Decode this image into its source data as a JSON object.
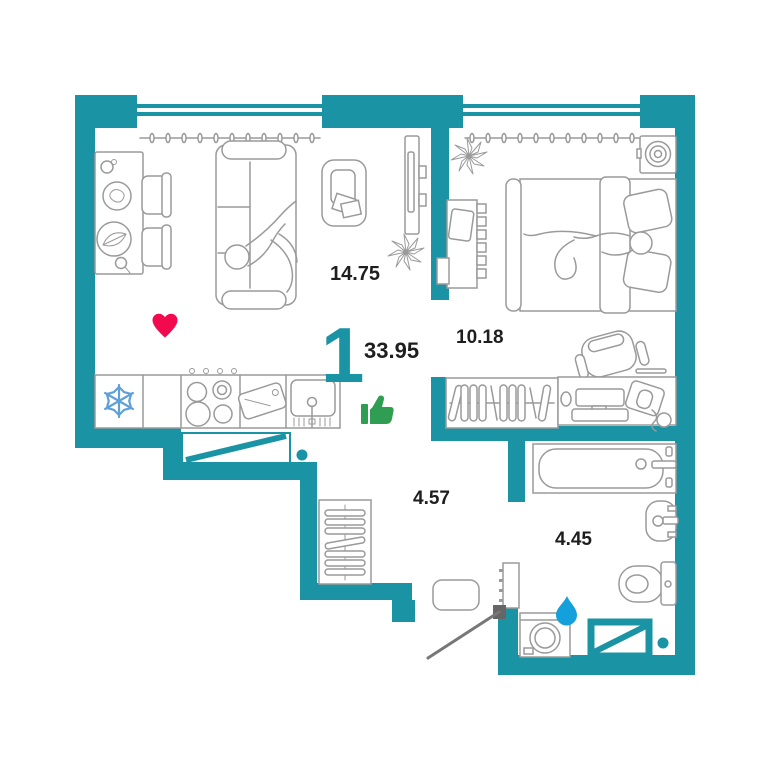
{
  "plan": {
    "rooms_count": "1",
    "total_area": "33.95"
  },
  "rooms": {
    "living_kitchen": {
      "area": "14.75"
    },
    "bedroom": {
      "area": "10.18"
    },
    "hall": {
      "area": "4.57"
    },
    "bathroom": {
      "area": "4.45"
    }
  },
  "icons": {
    "favorite": "heart-icon",
    "like": "thumbs-up-icon",
    "water_supply": "water-drop-icon",
    "fridge": "snowflake-icon",
    "entrance_door": "door-swing-icon",
    "kitchen_exit": "crossed-opening-icon",
    "shaft": "crossed-opening-icon"
  },
  "colors": {
    "accent": "#1a93a5",
    "text": "#1e1e1e",
    "heart": "#f2094e",
    "thumb": "#2f9e52",
    "drop": "#14a0da",
    "snowflake": "#5fa0d8",
    "furn": "#9a9a9a",
    "door": "#777777"
  }
}
